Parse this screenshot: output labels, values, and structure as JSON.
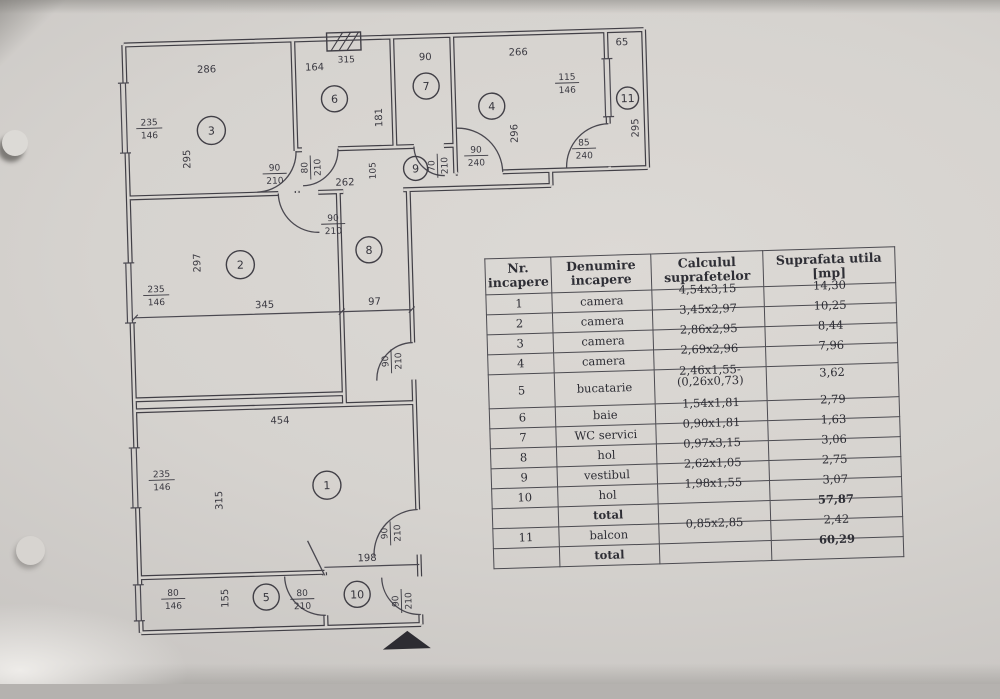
{
  "plan": {
    "rooms": {
      "r1": "1",
      "r2": "2",
      "r3": "3",
      "r4": "4",
      "r5": "5",
      "r6": "6",
      "r7": "7",
      "r8": "8",
      "r9": "9",
      "r10": "10",
      "r11": "11"
    },
    "dims": {
      "w286": "286",
      "h295": "295",
      "w164": "164",
      "h181": "181",
      "w90": "90",
      "w266": "266",
      "h296": "296",
      "w65": "65",
      "hb295": "295",
      "w262": "262",
      "h105": "105",
      "w345": "345",
      "h297": "297",
      "w97": "97",
      "w454": "454",
      "h315": "315",
      "h155": "155",
      "w198": "198",
      "vent": "315"
    },
    "f": {
      "win235": {
        "top": "235",
        "bot": "146"
      },
      "win115": {
        "top": "115",
        "bot": "146"
      },
      "win80": {
        "top": "80",
        "bot": "146"
      },
      "d90210": {
        "top": "90",
        "bot": "210"
      },
      "d80210": {
        "top": "80",
        "bot": "210"
      },
      "d70210": {
        "top": "70",
        "bot": "210"
      },
      "d90240": {
        "top": "90",
        "bot": "240"
      },
      "d85240": {
        "top": "85",
        "bot": "240"
      }
    }
  },
  "table": {
    "headers": [
      "Nr. incapere",
      "Denumire incapere",
      "Calculul suprafetelor",
      "Suprafata utila [mp]"
    ],
    "rows": [
      {
        "nr": "1",
        "name": "camera",
        "calc": "4,54x3,15",
        "area": "14,30"
      },
      {
        "nr": "2",
        "name": "camera",
        "calc": "3,45x2,97",
        "area": "10,25"
      },
      {
        "nr": "3",
        "name": "camera",
        "calc": "2,86x2,95",
        "area": "8,44"
      },
      {
        "nr": "4",
        "name": "camera",
        "calc": "2,69x2,96",
        "area": "7,96"
      },
      {
        "nr": "5",
        "name": "bucatarie",
        "calc": "2,46x1,55-",
        "calc2": "(0,26x0,73)",
        "area": "3,62"
      },
      {
        "nr": "6",
        "name": "baie",
        "calc": "1,54x1,81",
        "area": "2,79"
      },
      {
        "nr": "7",
        "name": "WC servici",
        "calc": "0,90x1,81",
        "area": "1,63"
      },
      {
        "nr": "8",
        "name": "hol",
        "calc": "0,97x3,15",
        "area": "3,06"
      },
      {
        "nr": "9",
        "name": "vestibul",
        "calc": "2,62x1,05",
        "area": "2,75"
      },
      {
        "nr": "10",
        "name": "hol",
        "calc": "1,98x1,55",
        "area": "3,07"
      },
      {
        "nr": "",
        "name": "total",
        "calc": "",
        "area": "57,87"
      },
      {
        "nr": "11",
        "name": "balcon",
        "calc": "0,85x2,85",
        "area": "2,42"
      },
      {
        "nr": "",
        "name": "total",
        "calc": "",
        "area": "60,29"
      }
    ]
  }
}
